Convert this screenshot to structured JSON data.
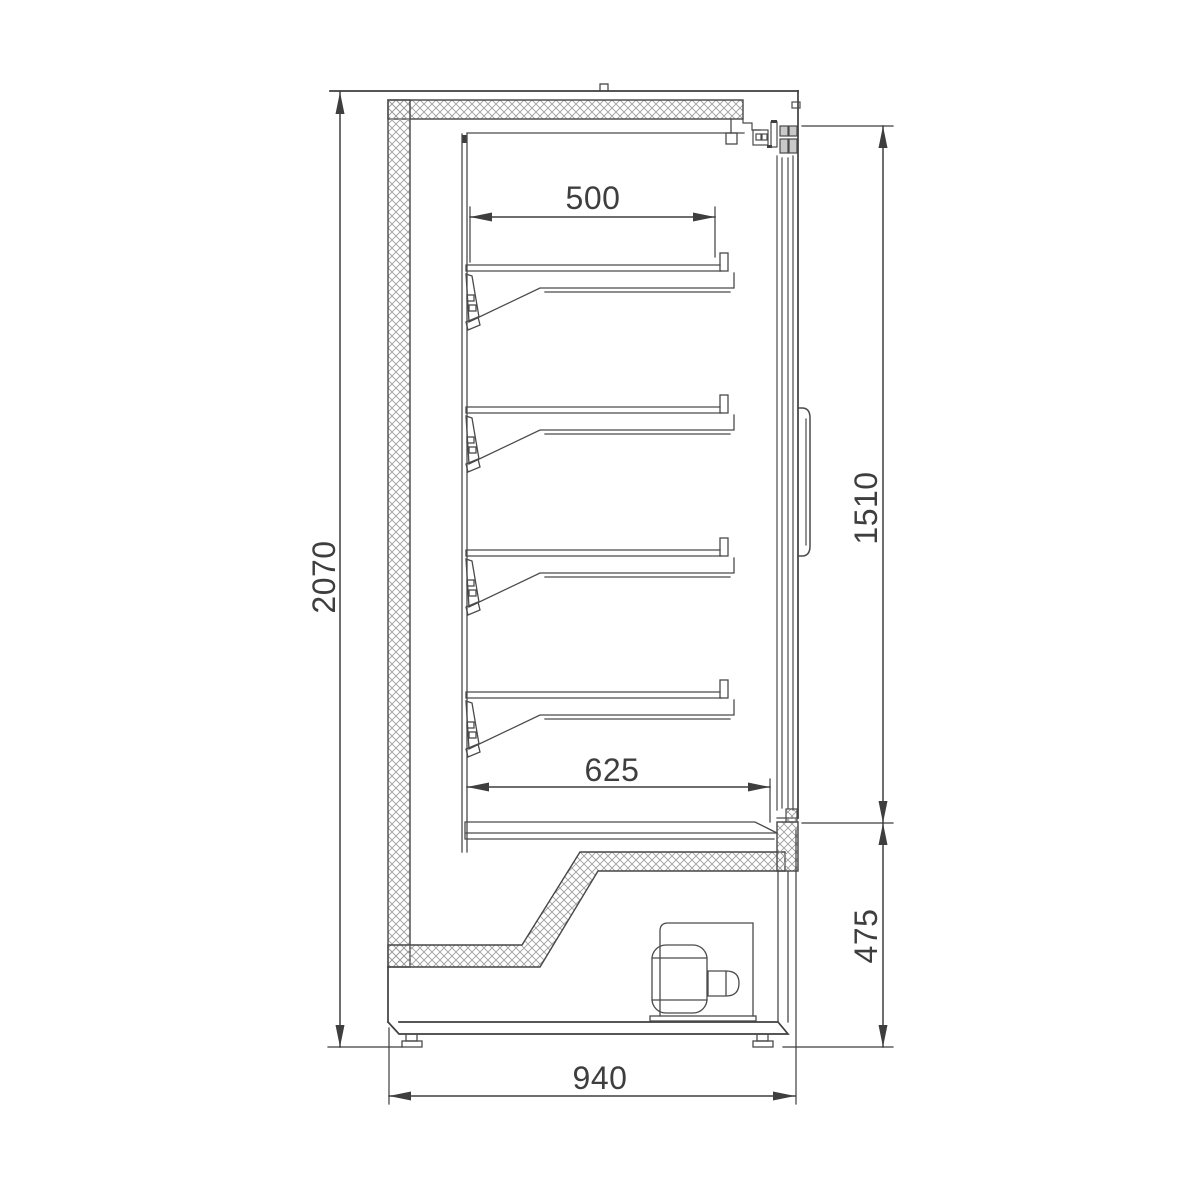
{
  "drawing": {
    "type": "technical dimension drawing",
    "view": "side cross-section of refrigerated display cabinet",
    "dimensions": {
      "overall_height": "2070",
      "shelf_depth": "500",
      "door_opening_height": "1510",
      "lower_interior_depth": "625",
      "base_section_height": "475",
      "overall_depth": "940"
    },
    "colors": {
      "background": "#ffffff",
      "line": "#3e3e3e",
      "hatch": "#9a9a9a"
    }
  }
}
